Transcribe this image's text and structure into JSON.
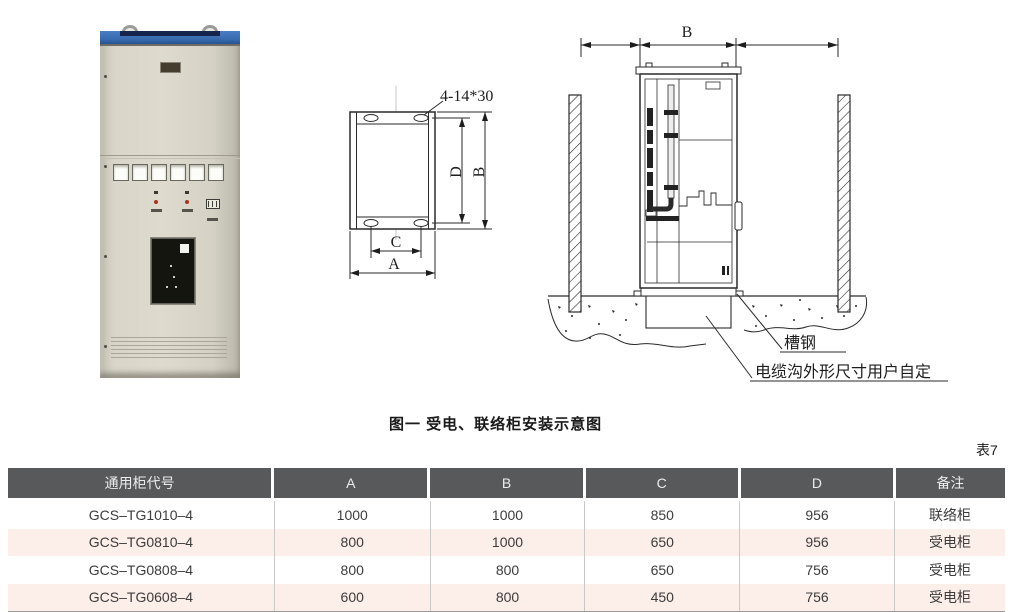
{
  "figure": {
    "caption": "图一 受电、联络柜安装示意图",
    "table_tag": "表7"
  },
  "plan_view": {
    "hole_label": "4-14*30",
    "dim_a": "A",
    "dim_b": "B",
    "dim_c": "C",
    "dim_d": "D"
  },
  "side_view": {
    "dim_b": "B",
    "channel_steel_label": "槽钢",
    "cable_trench_label": "电缆沟外形尺寸用户自定"
  },
  "table": {
    "headers": [
      "通用柜代号",
      "A",
      "B",
      "C",
      "D",
      "备注"
    ],
    "rows": [
      [
        "GCS–TG1010–4",
        "1000",
        "1000",
        "850",
        "956",
        "联络柜"
      ],
      [
        "GCS–TG0810–4",
        "800",
        "1000",
        "650",
        "956",
        "受电柜"
      ],
      [
        "GCS–TG0808–4",
        "800",
        "800",
        "650",
        "756",
        "受电柜"
      ],
      [
        "GCS–TG0608–4",
        "600",
        "800",
        "450",
        "756",
        "受电柜"
      ]
    ]
  },
  "colors": {
    "table_header_bg": "#58595b",
    "table_row_pink": "#fceee9",
    "cabinet_blue_band": "#3567ac",
    "cabinet_body": "#d9d6c9",
    "line_color": "#1d1d1d"
  }
}
